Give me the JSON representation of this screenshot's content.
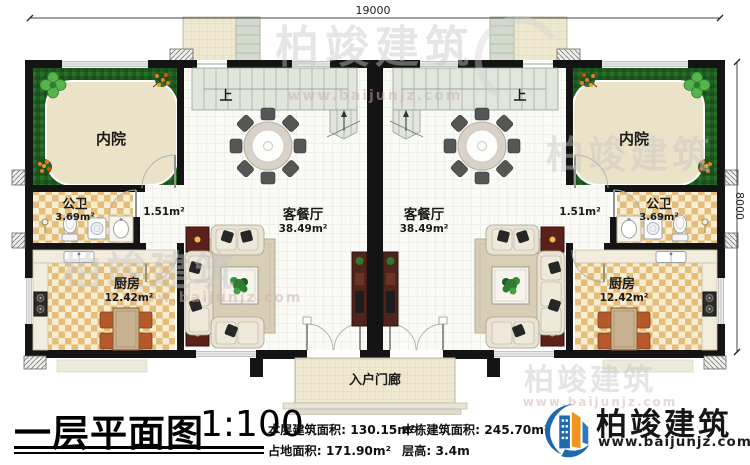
{
  "dimensions": {
    "top": "19000",
    "right": "8000"
  },
  "rooms": {
    "courtyard": "内院",
    "bathroom": "公卫",
    "bathroom_area": "3.69m²",
    "hall_area": "1.51m²",
    "kitchen": "厨房",
    "kitchen_area": "12.42m²",
    "living": "客餐厅",
    "living_area": "38.49m²",
    "stairs_up": "上",
    "porch": "入户门廊"
  },
  "title_block": {
    "title": "一层平面图",
    "scale": "1:100",
    "stats": [
      {
        "label": "本层建筑面积:",
        "value": "130.15m²"
      },
      {
        "label": "本栋建筑面积:",
        "value": "245.70m²"
      },
      {
        "label": "占地面积:",
        "value": "171.90m²"
      },
      {
        "label": "层高:",
        "value": "3.4m"
      }
    ],
    "logo_name": "柏竣建筑",
    "logo_site": "www.baijunjz.com"
  },
  "watermark": {
    "brand": "柏竣建筑",
    "url": "www.baijunjz.com"
  }
}
